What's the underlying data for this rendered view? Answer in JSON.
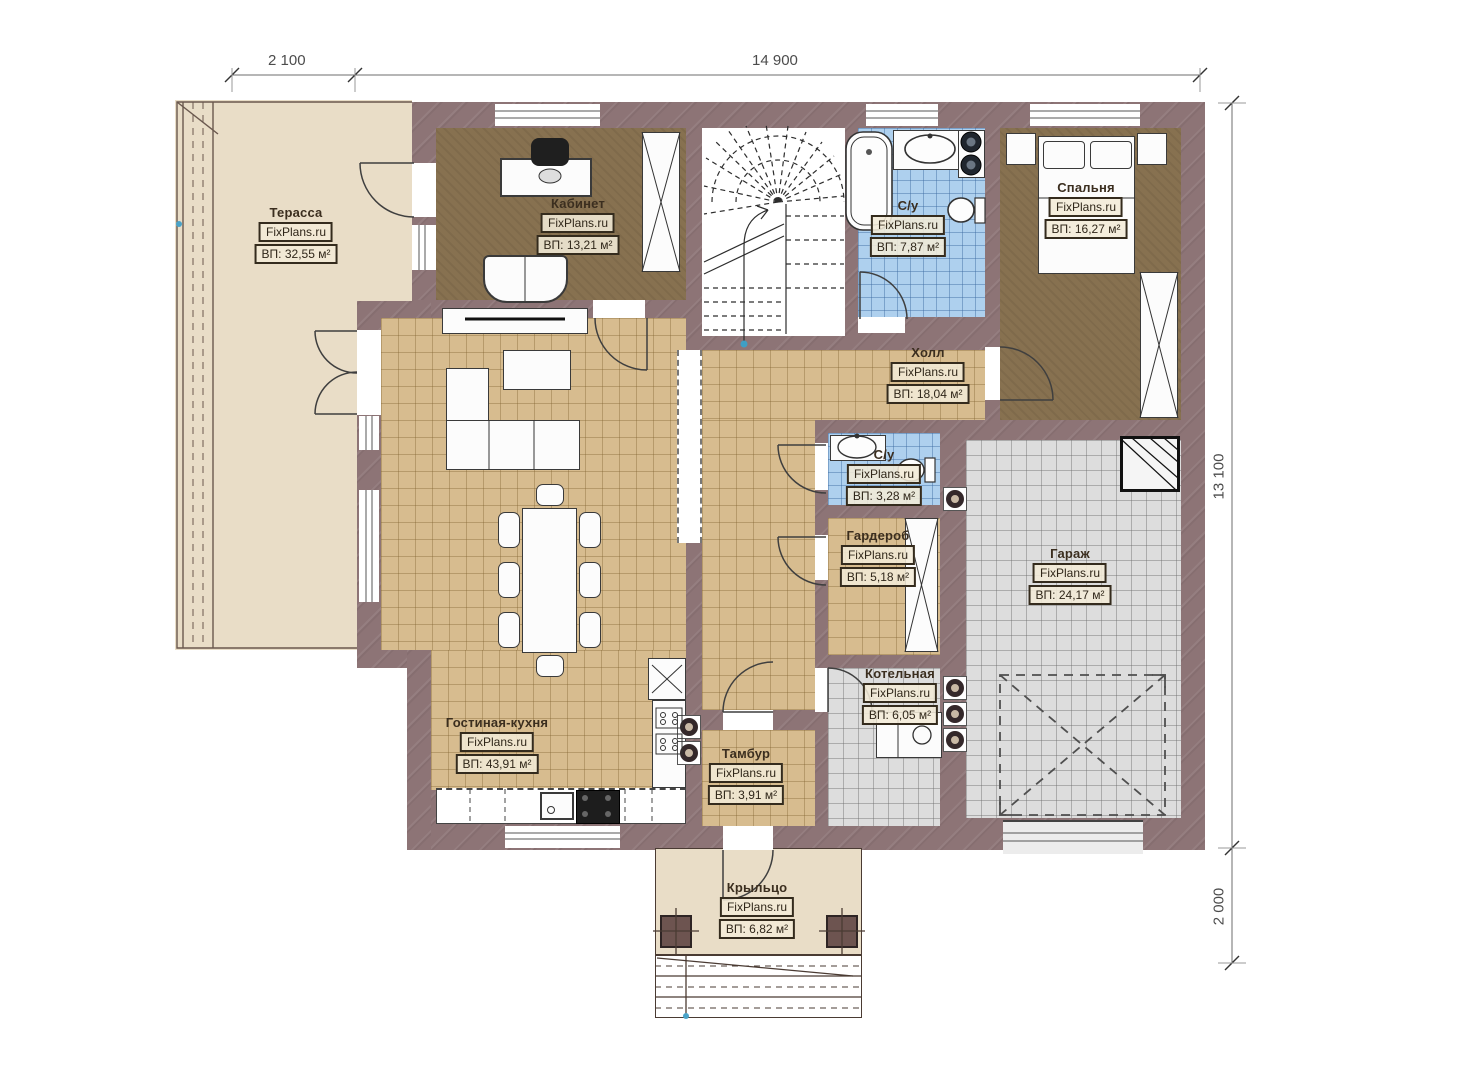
{
  "meta": {
    "brand": "FixPlans.ru",
    "plan_type": "floor-plan"
  },
  "dimensions": {
    "top_left": "2 100",
    "top_main": "14 900",
    "right_main": "13 100",
    "right_bottom": "2 000"
  },
  "rooms": [
    {
      "name": "Терасса",
      "area": "ВП: 32,55 м²"
    },
    {
      "name": "Кабинет",
      "area": "ВП: 13,21 м²"
    },
    {
      "name": "С/у",
      "area": "ВП: 7,87 м²"
    },
    {
      "name": "Спальня",
      "area": "ВП: 16,27 м²"
    },
    {
      "name": "Холл",
      "area": "ВП: 18,04 м²"
    },
    {
      "name": "С/у",
      "area": "ВП: 3,28 м²"
    },
    {
      "name": "Гардероб",
      "area": "ВП: 5,18 м²"
    },
    {
      "name": "Гараж",
      "area": "ВП: 24,17 м²"
    },
    {
      "name": "Гостиная-кухня",
      "area": "ВП: 43,91 м²"
    },
    {
      "name": "Котельная",
      "area": "ВП: 6,05 м²"
    },
    {
      "name": "Тамбур",
      "area": "ВП: 3,91 м²"
    },
    {
      "name": "Крыльцо",
      "area": "ВП: 6,82 м²"
    }
  ]
}
